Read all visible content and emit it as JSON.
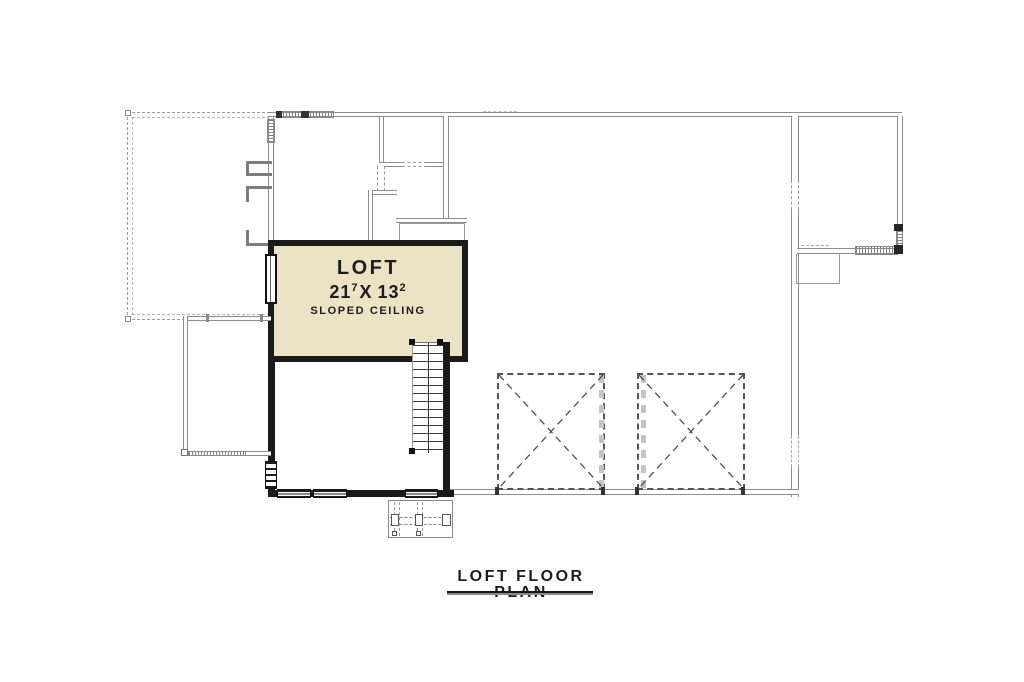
{
  "plan": {
    "loft": {
      "label": "LOFT",
      "dim_main_1": "21",
      "dim_sup_1": "7",
      "dim_separator": "X",
      "dim_main_2": "13",
      "dim_sup_2": "2",
      "ceiling_note": "SLOPED CEILING",
      "fill_color": "#ece3c4"
    },
    "caption": {
      "text": "LOFT FLOOR PLAN"
    },
    "colors": {
      "thick_wall": "#1a1a1a",
      "thin_wall": "#8d8d8d",
      "dashed_line": "#4f4f4f",
      "hatch": "#828282",
      "text": "#1d1d1d",
      "background": "#ffffff"
    }
  }
}
